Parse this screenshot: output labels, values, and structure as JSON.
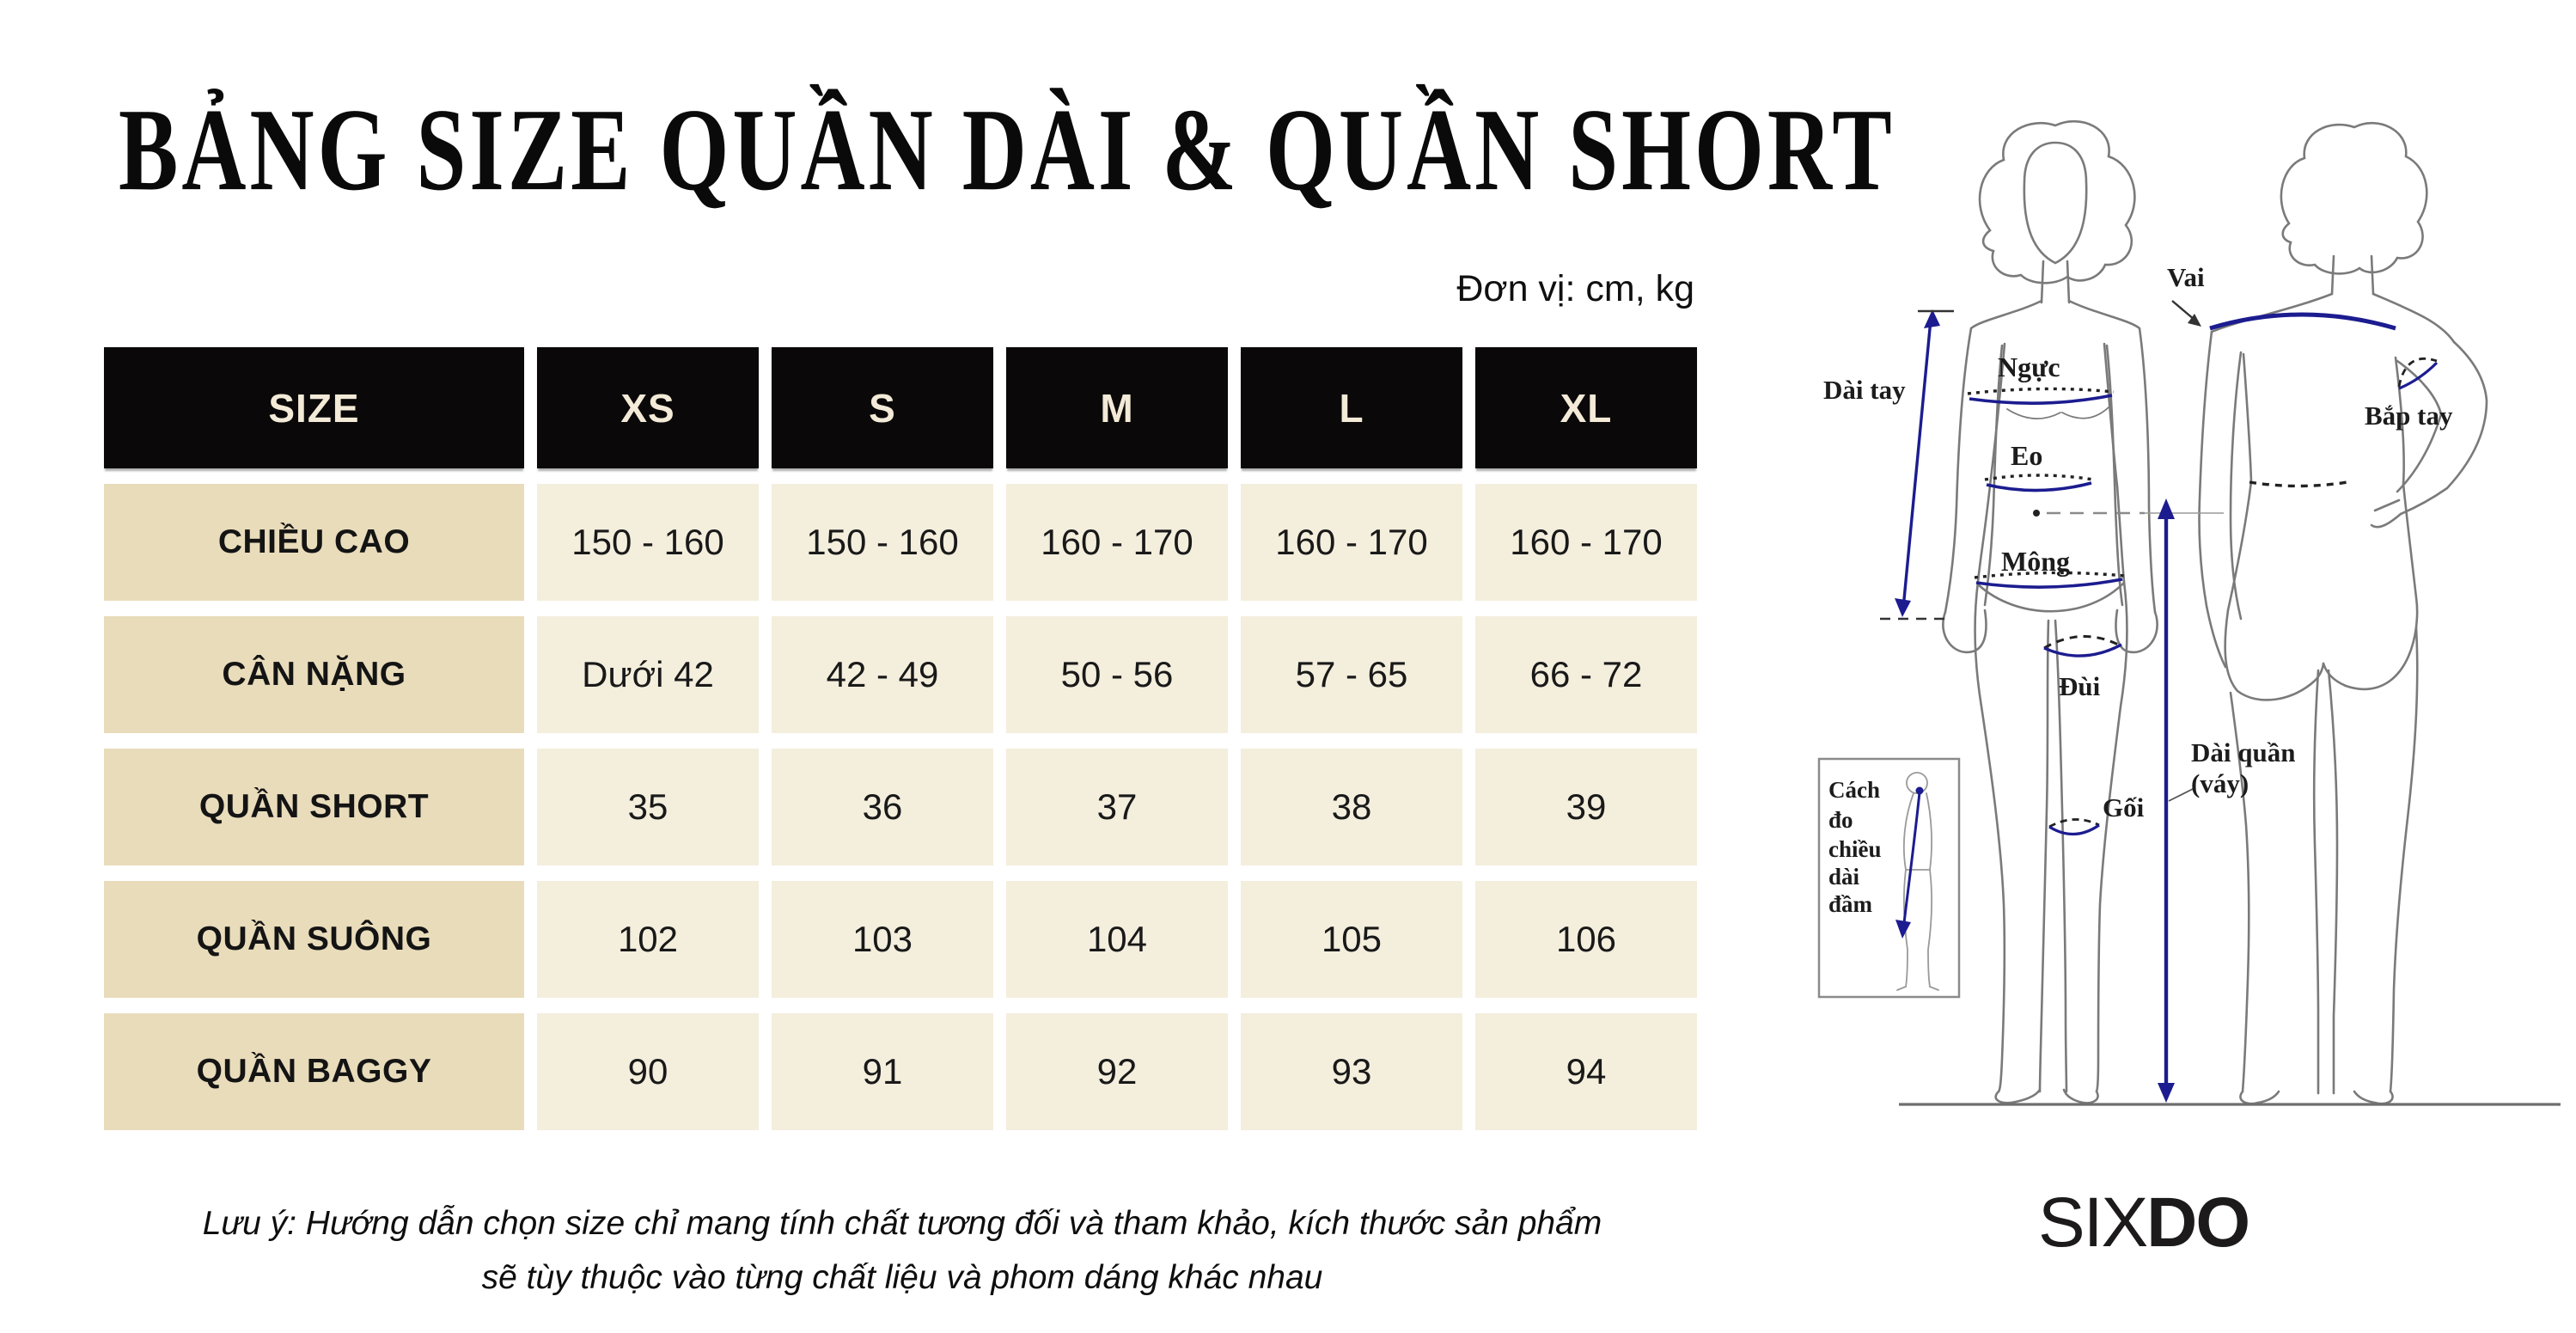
{
  "title": "BẢNG SIZE QUẦN DÀI & QUẦN SHORT",
  "unit_note": "Đơn vị: cm, kg",
  "size_table": {
    "header": [
      "SIZE",
      "XS",
      "S",
      "M",
      "L",
      "XL"
    ],
    "rows": [
      {
        "label": "CHIỀU CAO",
        "values": [
          "150 - 160",
          "150 - 160",
          "160 - 170",
          "160 - 170",
          "160 - 170"
        ]
      },
      {
        "label": "CÂN NẶNG",
        "values": [
          "Dưới 42",
          "42 - 49",
          "50 - 56",
          "57 - 65",
          "66 - 72"
        ]
      },
      {
        "label": "QUẦN SHORT",
        "values": [
          "35",
          "36",
          "37",
          "38",
          "39"
        ]
      },
      {
        "label": "QUẦN SUÔNG",
        "values": [
          "102",
          "103",
          "104",
          "105",
          "106"
        ]
      },
      {
        "label": "QUẦN BAGGY",
        "values": [
          "90",
          "91",
          "92",
          "93",
          "94"
        ]
      }
    ]
  },
  "chart_data": {
    "type": "table",
    "title": "BẢNG SIZE QUẦN DÀI & QUẦN SHORT",
    "unit": "cm, kg",
    "columns": [
      "SIZE",
      "XS",
      "S",
      "M",
      "L",
      "XL"
    ],
    "rows": [
      [
        "CHIỀU CAO",
        "150 - 160",
        "150 - 160",
        "160 - 170",
        "160 - 170",
        "160 - 170"
      ],
      [
        "CÂN NẶNG",
        "Dưới 42",
        "42 - 49",
        "50 - 56",
        "57 - 65",
        "66 - 72"
      ],
      [
        "QUẦN SHORT",
        "35",
        "36",
        "37",
        "38",
        "39"
      ],
      [
        "QUẦN SUÔNG",
        "102",
        "103",
        "104",
        "105",
        "106"
      ],
      [
        "QUẦN BAGGY",
        "90",
        "91",
        "92",
        "93",
        "94"
      ]
    ]
  },
  "footnote": {
    "line1": "Lưu ý: Hướng dẫn chọn size chỉ mang tính chất tương đối và tham khảo, kích thước sản phẩm",
    "line2": "sẽ tùy thuộc vào từng chất liệu và phom dáng khác nhau"
  },
  "diagram": {
    "labels": {
      "vai": "Vai",
      "dai_tay": "Dài tay",
      "nguc": "Ngực",
      "eo": "Eo",
      "mong": "Mông",
      "dui": "Đùi",
      "goi": "Gối",
      "bap_tay": "Bắp tay",
      "dai_quan_line1": "Dài quần",
      "dai_quan_line2": "(váy)",
      "inset_line1": "Cách",
      "inset_line2": "đo",
      "inset_line3": "chiều",
      "inset_line4": "dài",
      "inset_line5": "đầm"
    }
  },
  "brand": {
    "part1": "SIX",
    "part2": "DO"
  },
  "colors": {
    "header_bg": "#0a0808",
    "header_text": "#f3ead7",
    "row_label_bg": "#e9dcbb",
    "value_bg": "#f4eedd",
    "measure_blue": "#1c1c90",
    "outline_grey": "#7a7a7a"
  }
}
